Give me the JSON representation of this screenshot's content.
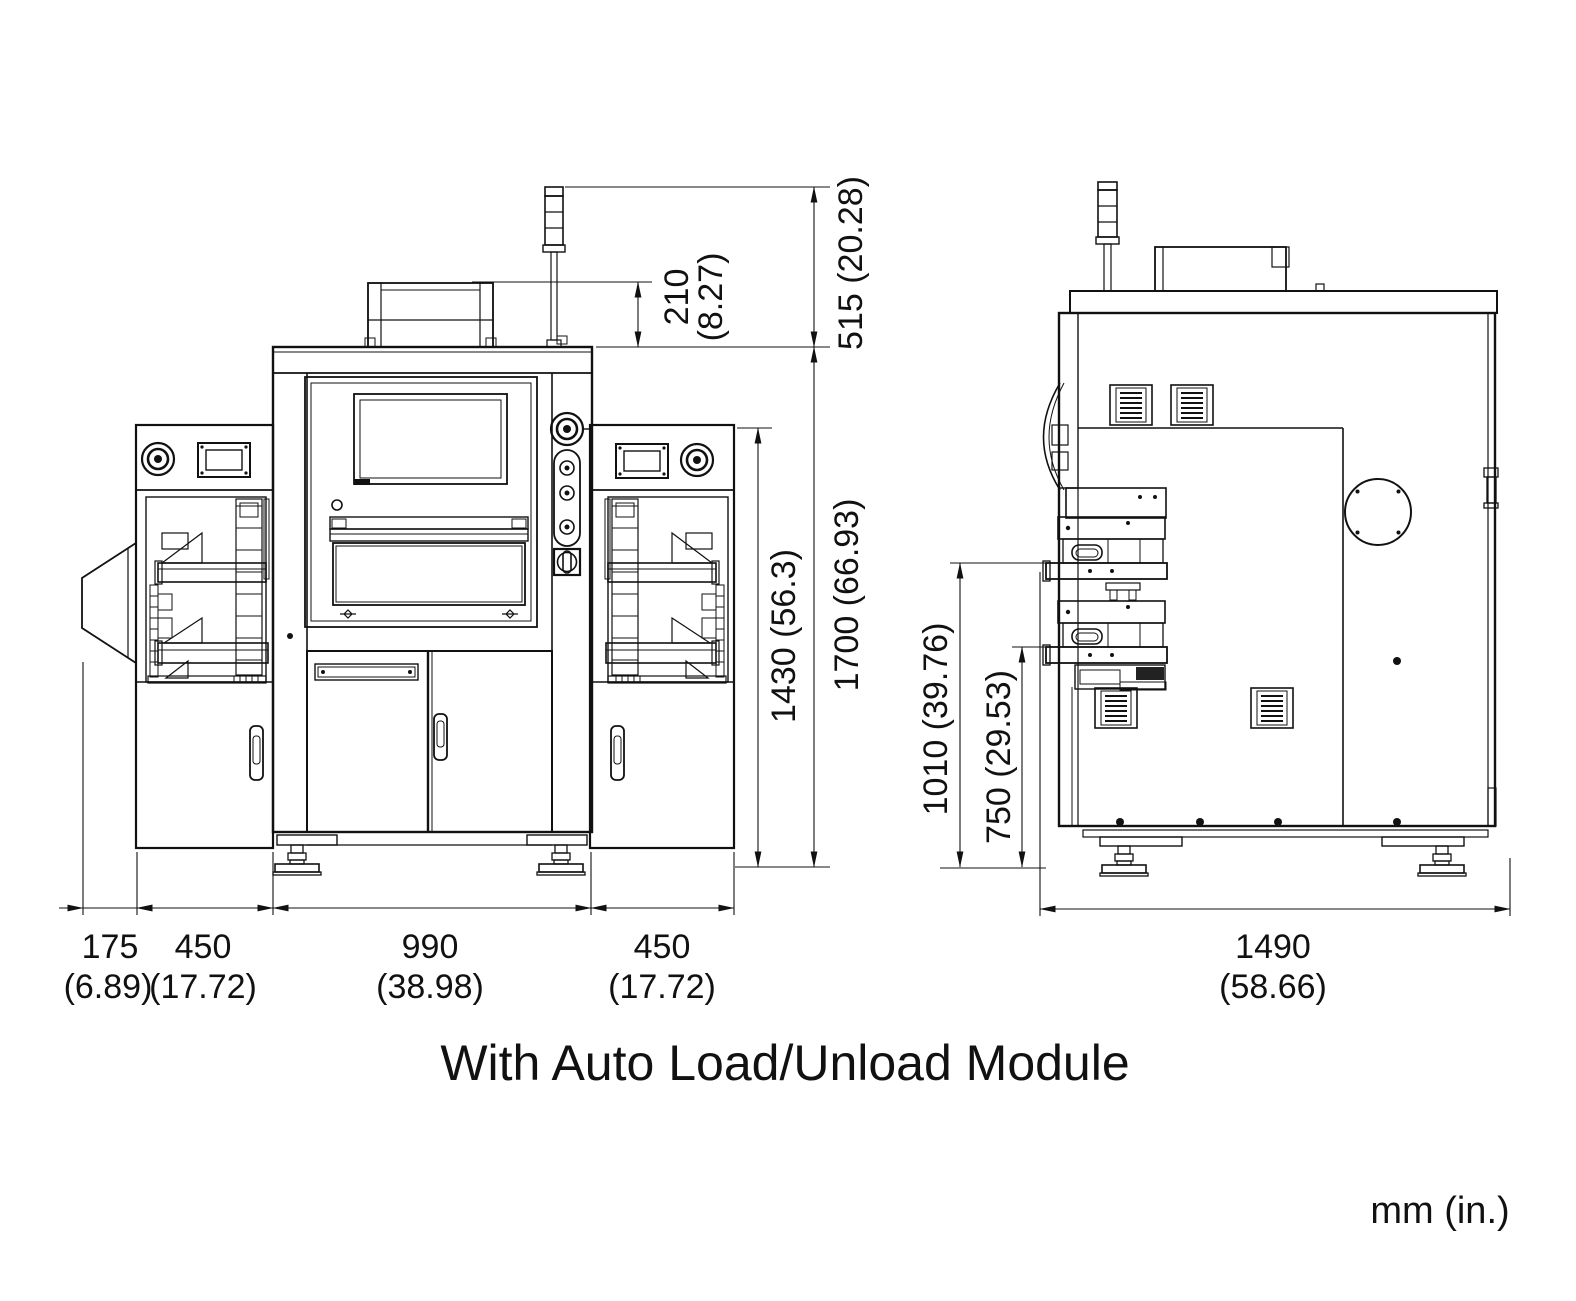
{
  "caption": "With Auto Load/Unload Module",
  "units_note": "mm (in.)",
  "drawing": {
    "type": "engineering-dimension-drawing",
    "views": [
      "front elevation",
      "side elevation"
    ],
    "line_color": "#111111",
    "background": "#ffffff"
  },
  "dimensions": {
    "front": {
      "top_box_height_mm": "210",
      "top_box_height_in": "(8.27)",
      "tower_above_roof": "515 (20.28)",
      "module_height": "1430 (56.3)",
      "overall_height": "1700 (66.93)",
      "chute_mm": "175",
      "chute_in": "(6.89)",
      "left_module_mm": "450",
      "left_module_in": "(17.72)",
      "center_mm": "990",
      "center_in": "(38.98)",
      "right_module_mm": "450",
      "right_module_in": "(17.72)"
    },
    "side": {
      "upper_level": "1010 (39.76)",
      "lower_level": "750 (29.53)",
      "depth_mm": "1490",
      "depth_in": "(58.66)"
    }
  }
}
